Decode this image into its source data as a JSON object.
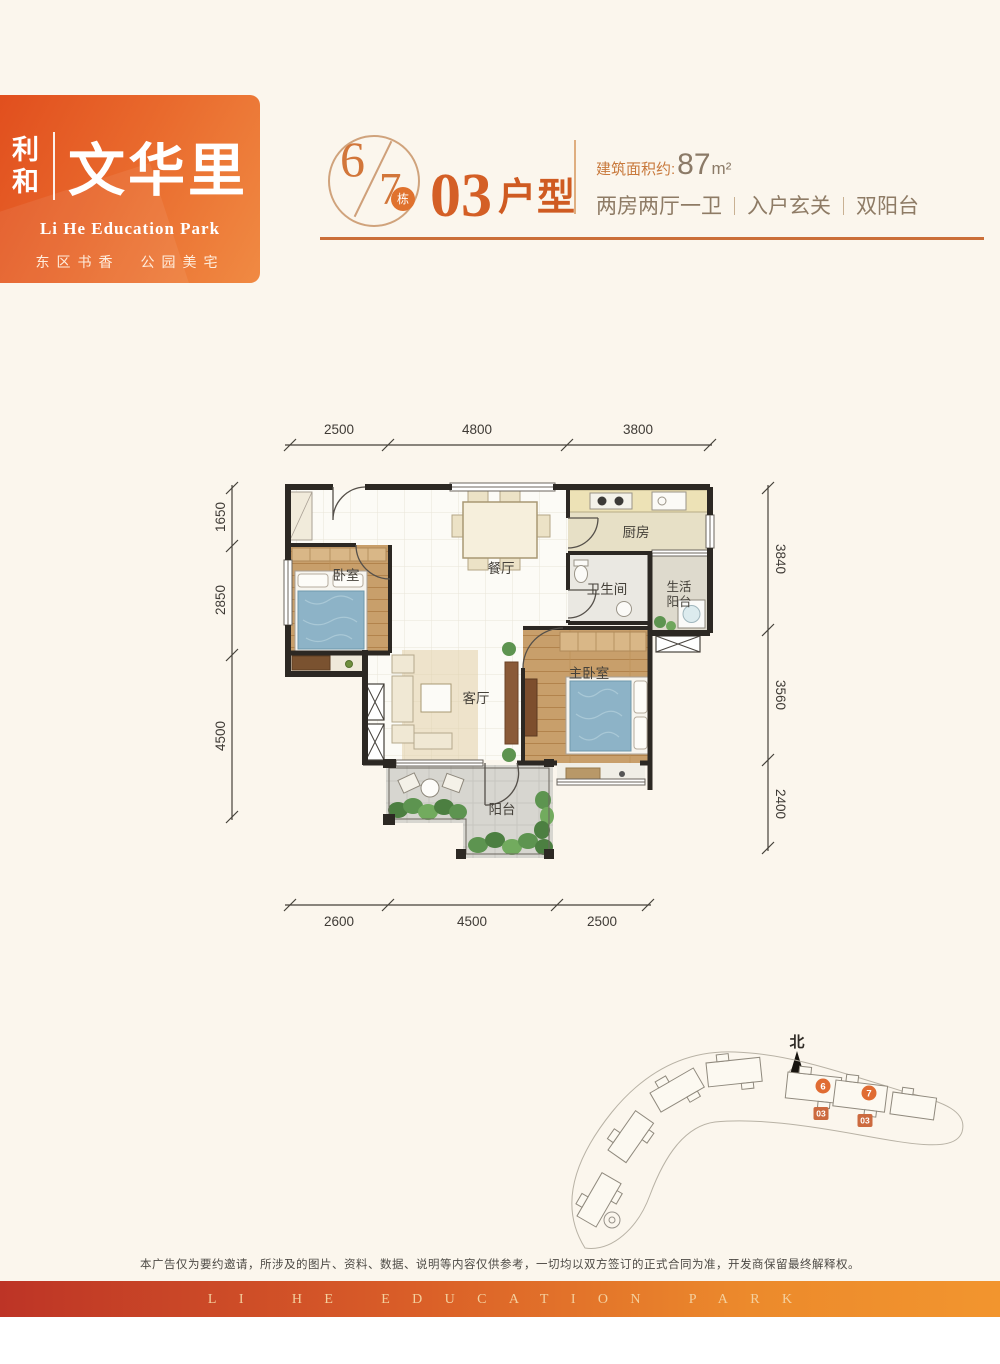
{
  "brand": {
    "name_char1": "利",
    "name_char2": "和",
    "name_main": "文华里",
    "tagline_en": "Li He Education Park",
    "tagline_cn": "东区书香　公园美宅"
  },
  "header": {
    "building_no_first": "6",
    "building_no_second": "7",
    "building_unit_label": "栋",
    "unit_code": "03",
    "unit_type_label": "户型",
    "area_prefix": "建筑面积约:",
    "area_value": "87",
    "area_unit": "m²",
    "features": [
      "两房两厅一卫",
      "入户玄关",
      "双阳台"
    ]
  },
  "floor_plan": {
    "rooms": {
      "bedroom": "卧室",
      "dining": "餐厅",
      "kitchen": "厨房",
      "bathroom": "卫生间",
      "utility_balcony_line1": "生活",
      "utility_balcony_line2": "阳台",
      "living": "客厅",
      "master_bedroom": "主卧室",
      "balcony": "阳台"
    },
    "dimensions": {
      "top": {
        "d1": "2500",
        "d2": "4800",
        "d3": "3800"
      },
      "left": {
        "d1": "1650",
        "d2": "2850",
        "d3": "4500"
      },
      "right": {
        "d1": "3840",
        "d2": "3560",
        "d3": "2400"
      },
      "bottom": {
        "d1": "2600",
        "d2": "4500",
        "d3": "2500"
      }
    }
  },
  "site_plan": {
    "north_label": "北",
    "building6_label": "6",
    "building7_label": "7",
    "unit_marker": "03"
  },
  "footer": {
    "disclaimer": "本广告仅为要约邀请，所涉及的图片、资料、数据、说明等内容仅供参考，一切均以双方签订的正式合同为准，开发商保留最终解释权。",
    "banner_text": "LI HE EDUCATION PARK"
  },
  "colors": {
    "brand_orange": "#e8622c",
    "accent_orange": "#d4712f",
    "banner_gradient_start": "#bd3426",
    "banner_gradient_end": "#f2952e"
  }
}
